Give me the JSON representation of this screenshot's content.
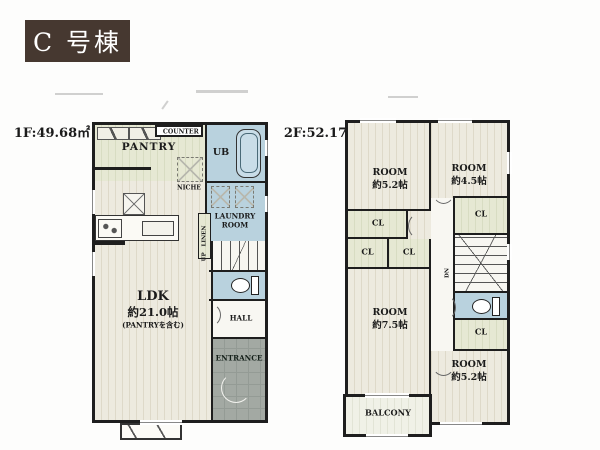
{
  "badge": {
    "label": "C 号棟",
    "bg": "#463830",
    "color": "#ffffff"
  },
  "f1": {
    "area": "1F:49.68㎡",
    "pantry": "PANTRY",
    "counter": "COUNTER",
    "ub": "UB",
    "niche": "NICHE",
    "laundry": "LAUNDRY\nROOM",
    "linen": "LINEN",
    "up": "UP",
    "ldk": "LDK",
    "ldk_size": "約21.0帖",
    "ldk_note": "(PANTRYを含む)",
    "hall": "HALL",
    "entrance": "ENTRANCE"
  },
  "f2": {
    "area": "2F:52.17㎡",
    "room": "ROOM",
    "nw_size": "約5.2帖",
    "ne_size": "約4.5帖",
    "cl": "CL",
    "dn": "DN",
    "w_size": "約7.5帖",
    "se_size": "約5.2帖",
    "balcony": "BALCONY"
  },
  "colors": {
    "wall": "#1e1e1e",
    "wood_floor": "#edeadf",
    "wet_area": "#b9d2de",
    "closet": "#e6e8d3",
    "entrance_tile": "#a3a9a3",
    "balcony": "#f0f1e7",
    "badge_bg": "#463830"
  }
}
